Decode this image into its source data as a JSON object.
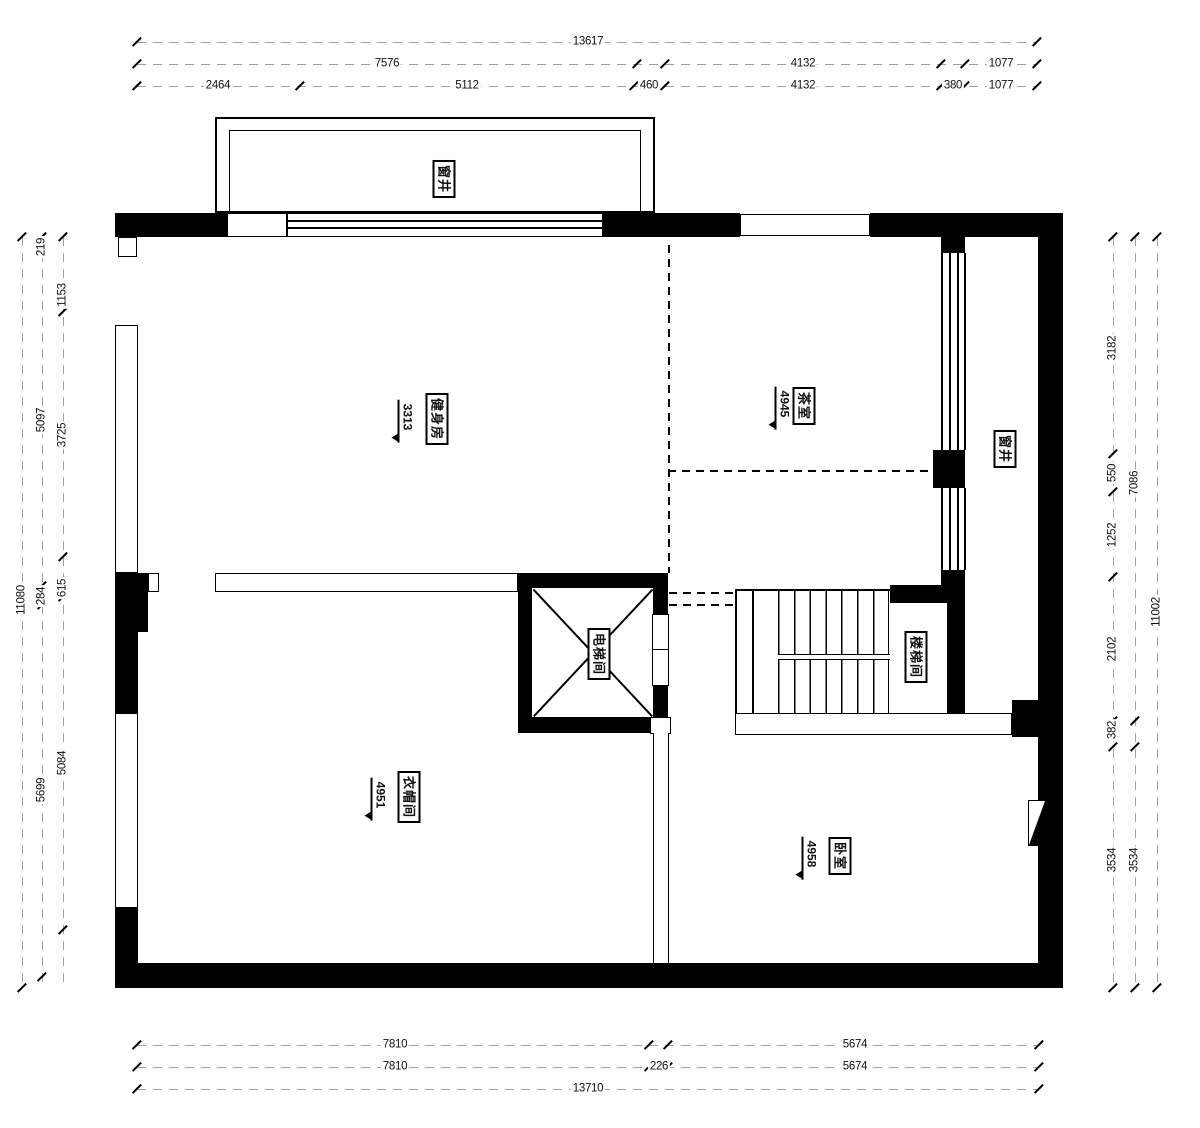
{
  "drawing": {
    "type": "residential floor plan",
    "colors": {
      "wall": "#000000",
      "dimension_line": "#a0a0a0",
      "text": "#111111"
    }
  },
  "rooms": {
    "window_well_top": {
      "name": "窗井"
    },
    "gym": {
      "name": "健身房",
      "level": "3313"
    },
    "tea_room": {
      "name": "茶室",
      "level": "4945"
    },
    "window_well_right": {
      "name": "窗井"
    },
    "elevator": {
      "name": "电梯间"
    },
    "stairwell": {
      "name": "楼梯间"
    },
    "cloakroom": {
      "name": "衣帽间",
      "level": "4951"
    },
    "bedroom": {
      "name": "卧室",
      "level": "4958"
    }
  },
  "dims": {
    "top": {
      "total": "13617",
      "row2": [
        "7576",
        "4132",
        "1077"
      ],
      "row3": [
        "2464",
        "5112",
        "460",
        "4132",
        "380",
        "1077"
      ]
    },
    "bottom": {
      "rowA": [
        "7810",
        "5674"
      ],
      "rowB": [
        "7810",
        "226",
        "5674"
      ],
      "total": "13710"
    },
    "left": {
      "total": "11080",
      "col2": [
        "219",
        "5097",
        "284",
        "5699"
      ],
      "col3": [
        "1153",
        "3725",
        "615",
        "5084"
      ]
    },
    "right": {
      "col1": [
        "3182",
        "550",
        "1252",
        "2102",
        "382",
        "3534"
      ],
      "col2": [
        "7086",
        "3534"
      ],
      "total": "11002"
    }
  }
}
